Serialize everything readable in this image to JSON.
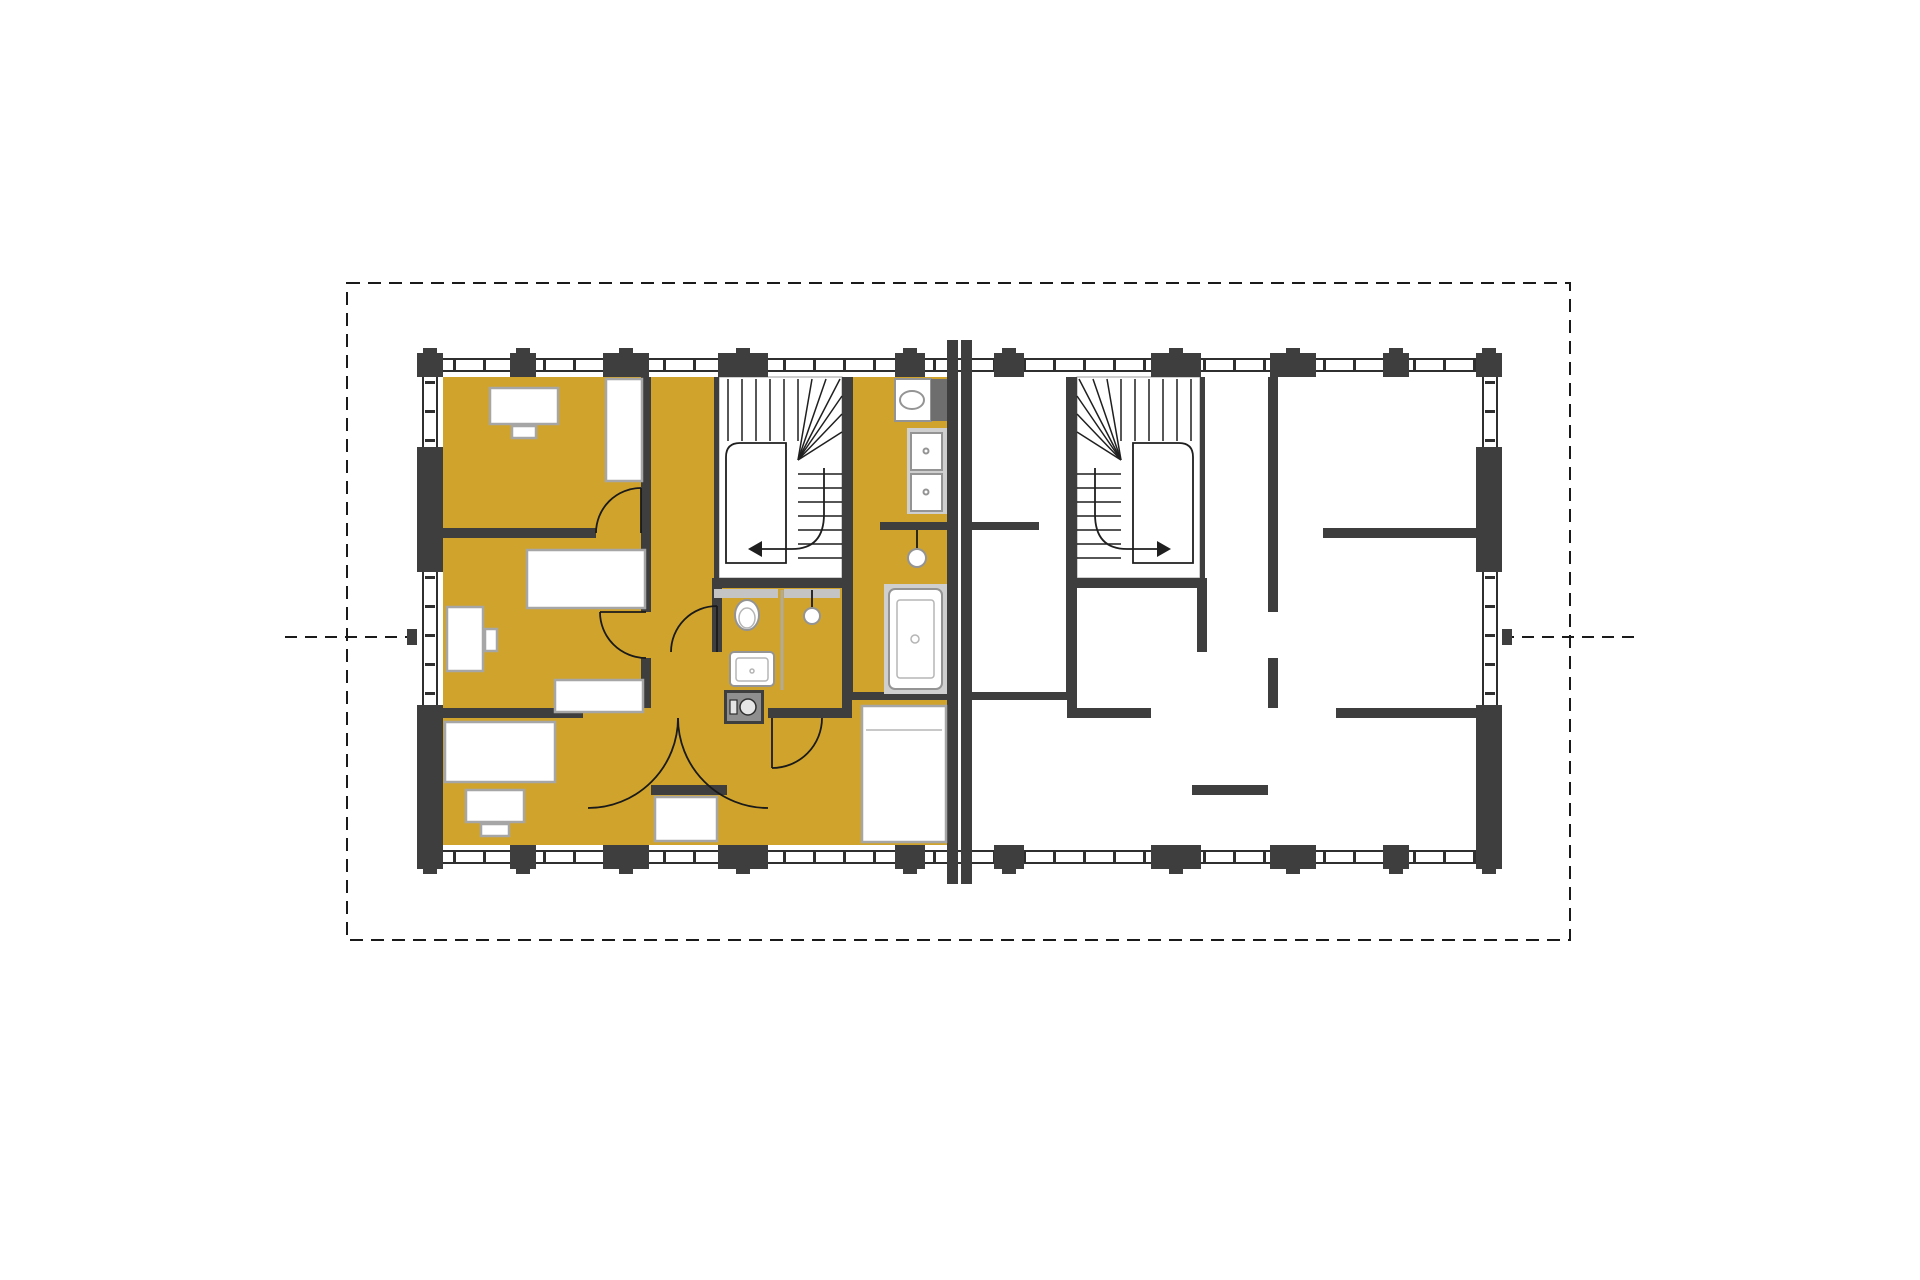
{
  "colors": {
    "unit_highlight": "#d0a42c",
    "wall": "#3e3e3e",
    "background": "#ffffff",
    "boundary_line": "#1a1a1a",
    "cabinet_gray": "#6e6e6e",
    "appliance_dark": "#3e3e3e",
    "appliance_inner": "#8f8f8f"
  },
  "floorplan": {
    "type": "residential floor plan with two mirrored townhouse units",
    "site_boundary_style": "dashed rectangle with side reference lines",
    "units": [
      {
        "id": "unit-left",
        "highlighted": true,
        "furnished": true,
        "stair_direction_arrow": "left",
        "fixtures": [
          "staircase",
          "toilet",
          "washbasin",
          "shower",
          "bathtub",
          "vanity-sink",
          "washer-dryer-stack",
          "washing-machine"
        ],
        "furniture": [
          "bed",
          "bed",
          "bed",
          "double-bed",
          "desk",
          "desk",
          "desk",
          "chair",
          "chair",
          "chair",
          "wardrobe",
          "wardrobe"
        ]
      },
      {
        "id": "unit-right",
        "highlighted": false,
        "furnished": false,
        "stair_direction_arrow": "right",
        "fixtures": [
          "staircase"
        ]
      }
    ]
  }
}
